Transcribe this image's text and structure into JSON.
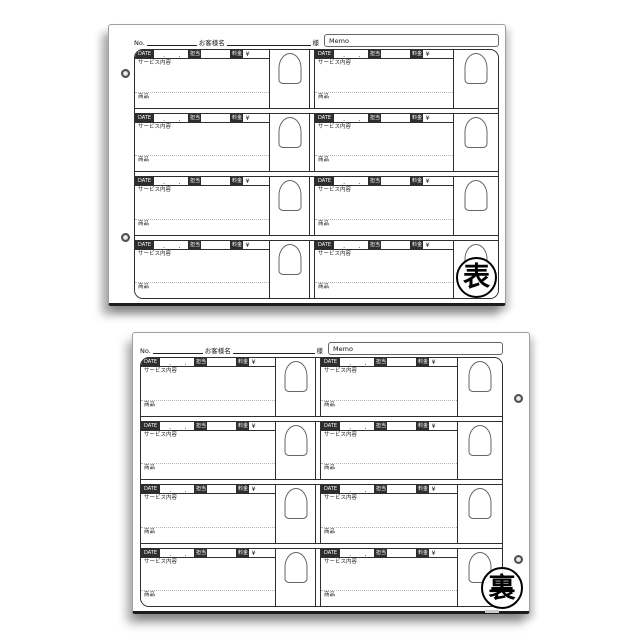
{
  "labels": {
    "no": "No.",
    "customer_name": "お客様名",
    "honorific": "様",
    "memo": "Memo",
    "date": "DATE",
    "date_dot": ".",
    "staff": "担当",
    "fee": "料金",
    "yen": "¥",
    "service_content": "サービス内容",
    "product": "商品"
  },
  "sheets": [
    {
      "side_stamp": "表",
      "holes_edge": "left"
    },
    {
      "side_stamp": "裏",
      "holes_edge": "right"
    }
  ],
  "grid": {
    "rows_per_sheet": 4,
    "record_columns_per_row": 2
  },
  "colors": {
    "tag_background": "#2e2e2e",
    "tag_text": "#ffffff",
    "border": "#2e2e2e",
    "stamp_ink": "#000000"
  }
}
